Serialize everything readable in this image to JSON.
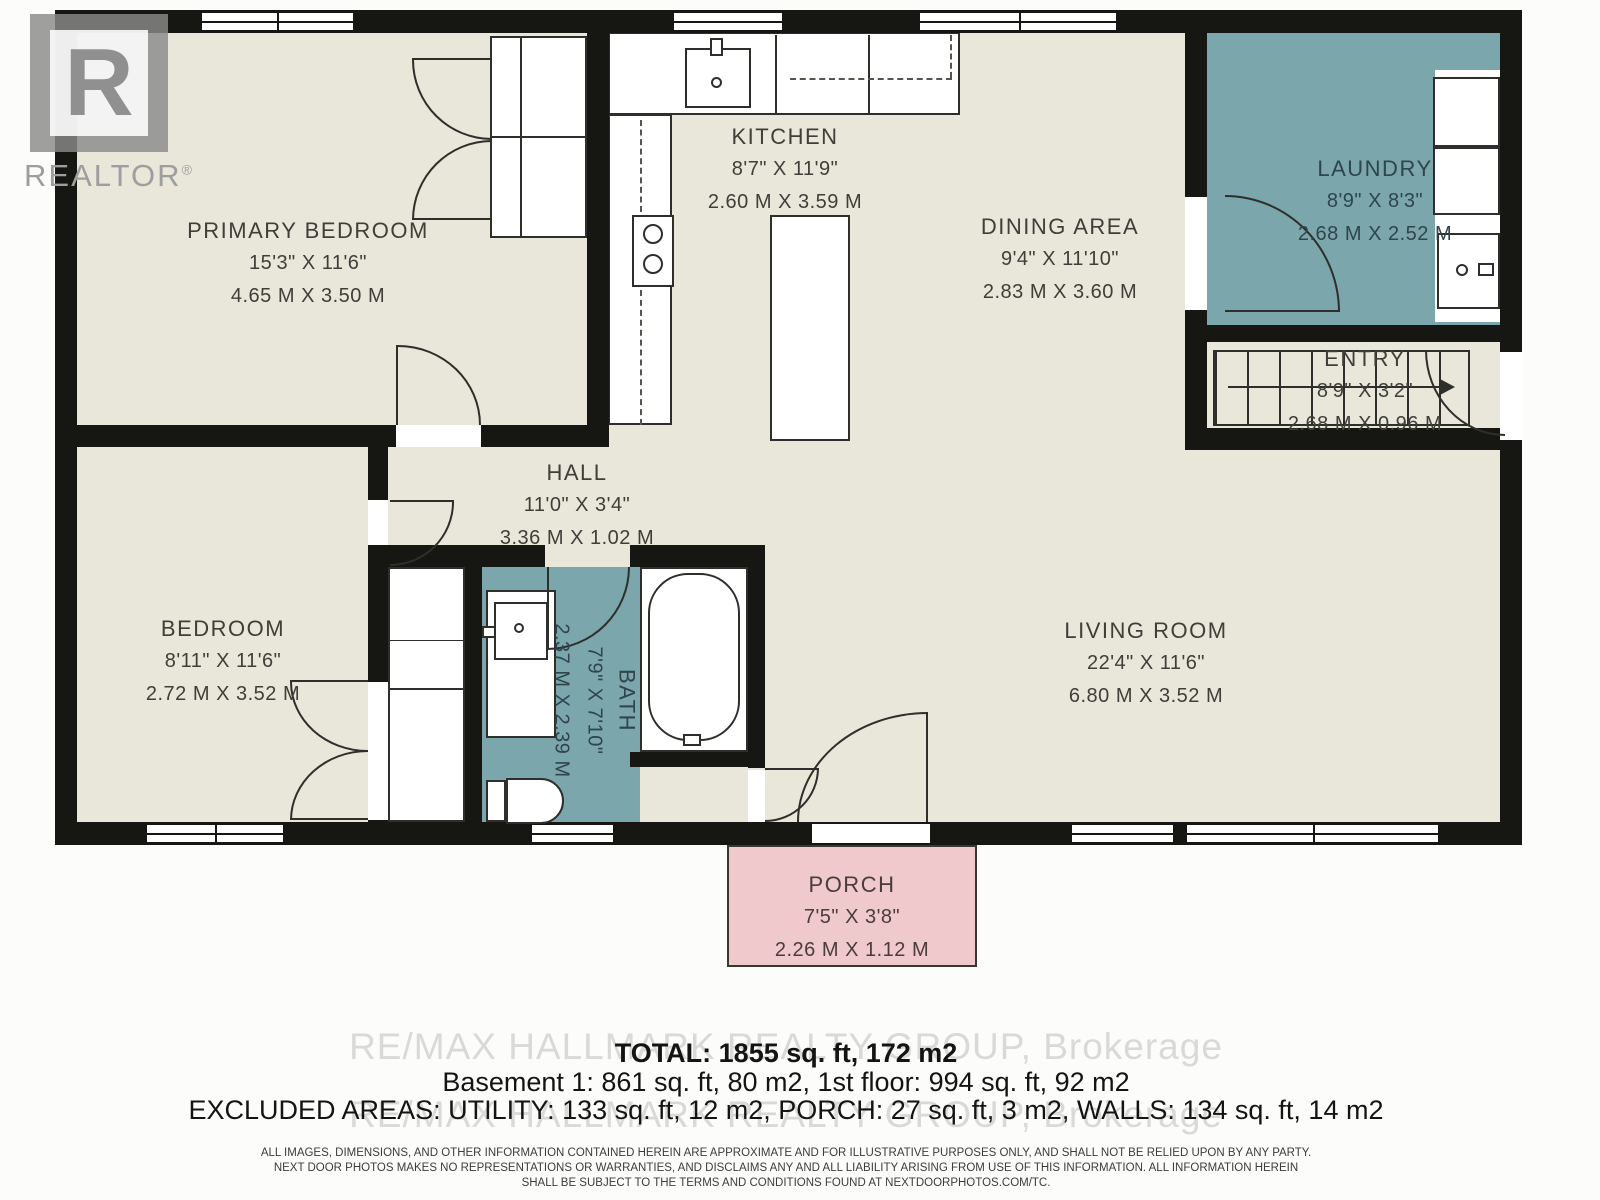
{
  "logo": {
    "brand": "REALTOR",
    "reg": "®"
  },
  "rooms": [
    {
      "id": "primary-bedroom",
      "name": "PRIMARY BEDROOM",
      "imperial": "15'3\" X 11'6\"",
      "metric": "4.65 M X 3.50 M"
    },
    {
      "id": "kitchen",
      "name": "KITCHEN",
      "imperial": "8'7\" X 11'9\"",
      "metric": "2.60 M X 3.59 M"
    },
    {
      "id": "dining-area",
      "name": "DINING AREA",
      "imperial": "9'4\" X 11'10\"",
      "metric": "2.83 M X 3.60 M"
    },
    {
      "id": "laundry",
      "name": "LAUNDRY",
      "imperial": "8'9\" X 8'3\"",
      "metric": "2.68 M X 2.52 M"
    },
    {
      "id": "entry",
      "name": "ENTRY",
      "imperial": "8'9\" X 3'2\"",
      "metric": "2.68 M X 0.96 M"
    },
    {
      "id": "hall",
      "name": "HALL",
      "imperial": "11'0\" X 3'4\"",
      "metric": "3.36 M X 1.02 M"
    },
    {
      "id": "bedroom",
      "name": "BEDROOM",
      "imperial": "8'11\" X 11'6\"",
      "metric": "2.72 M X 3.52 M"
    },
    {
      "id": "bath",
      "name": "BATH",
      "imperial": "7'9\" X 7'10\"",
      "metric": "2.37 M X 2.39 M"
    },
    {
      "id": "living-room",
      "name": "LIVING ROOM",
      "imperial": "22'4\" X 11'6\"",
      "metric": "6.80 M X 3.52 M"
    },
    {
      "id": "porch",
      "name": "PORCH",
      "imperial": "7'5\" X 3'8\"",
      "metric": "2.26 M X 1.12 M"
    }
  ],
  "summary": {
    "total": "TOTAL: 1855 sq. ft, 172 m2",
    "floors": "Basement 1: 861 sq. ft, 80 m2, 1st floor: 994 sq. ft, 92 m2",
    "excluded": "EXCLUDED AREAS: UTILITY: 133 sq. ft, 12 m2, PORCH: 27 sq. ft, 3 m2, WALLS: 134 sq. ft, 14 m2"
  },
  "watermark": "RE/MAX HALLMARK REALTY GROUP, Brokerage",
  "disclaimer": [
    "ALL IMAGES, DIMENSIONS, AND OTHER INFORMATION CONTAINED HEREIN ARE APPROXIMATE AND FOR ILLUSTRATIVE PURPOSES ONLY, AND SHALL NOT BE RELIED UPON BY ANY PARTY.",
    "NEXT DOOR PHOTOS MAKES NO REPRESENTATIONS OR WARRANTIES, AND DISCLAIMS ANY AND ALL LIABILITY ARISING FROM USE OF THIS INFORMATION. ALL INFORMATION HEREIN",
    "SHALL BE SUBJECT TO THE TERMS AND CONDITIONS FOUND AT NEXTDOORPHOTOS.COM/TC."
  ],
  "colors": {
    "floor": "#e9e6da",
    "wet_room": "#7aa6ac",
    "porch": "#efc9cb",
    "wall": "#161613"
  }
}
